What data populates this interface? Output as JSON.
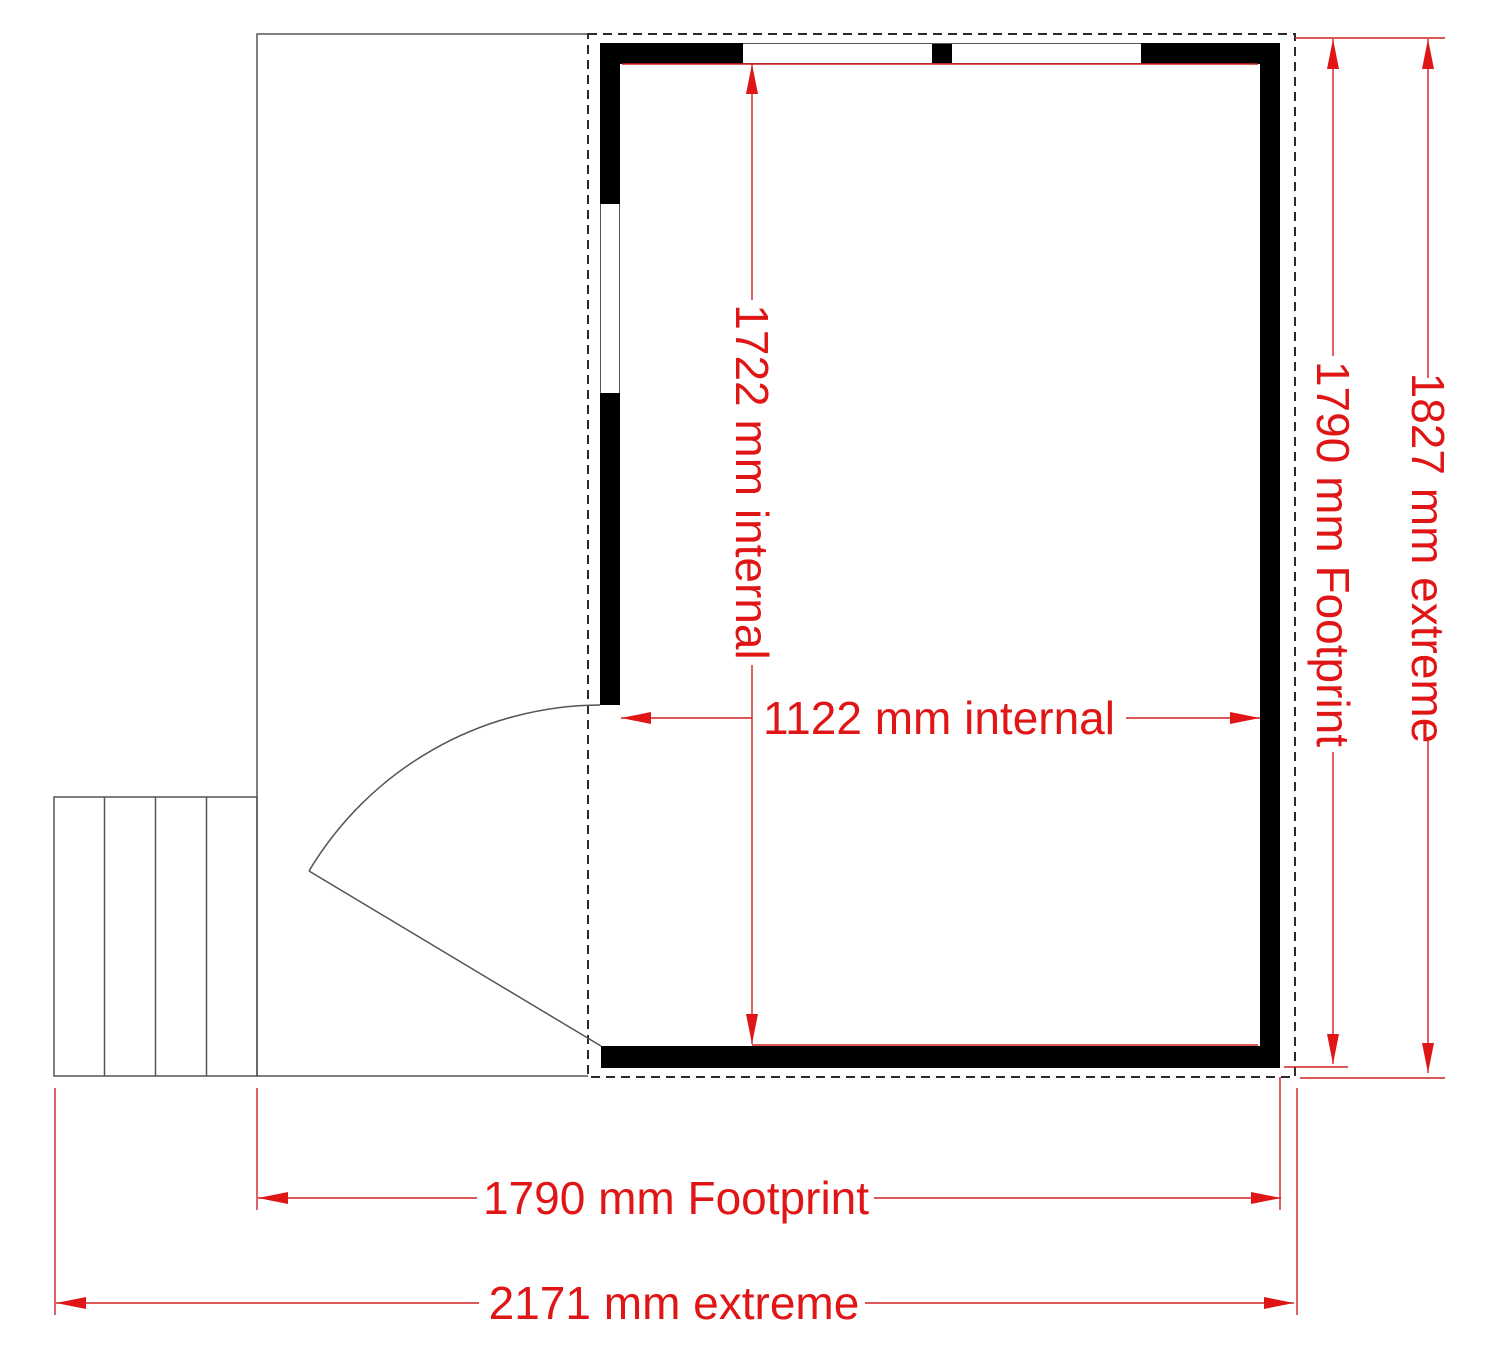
{
  "drawing": {
    "kind": "floor-plan",
    "background": "#ffffff"
  },
  "dimensions": {
    "internal_height": {
      "label": "1722 mm internal",
      "value": 1722,
      "unit": "mm",
      "orientation": "vertical"
    },
    "internal_width": {
      "label": "1122 mm internal",
      "value": 1122,
      "unit": "mm",
      "orientation": "horizontal"
    },
    "footprint_height": {
      "label": "1790 mm Footprint",
      "value": 1790,
      "unit": "mm",
      "orientation": "vertical"
    },
    "extreme_height": {
      "label": "1827 mm extreme",
      "value": 1827,
      "unit": "mm",
      "orientation": "vertical"
    },
    "footprint_width": {
      "label": "1790 mm Footprint",
      "value": 1790,
      "unit": "mm",
      "orientation": "horizontal"
    },
    "extreme_width": {
      "label": "2171 mm extreme",
      "value": 2171,
      "unit": "mm",
      "orientation": "horizontal"
    }
  },
  "features": {
    "step_treads": 4,
    "windows": 3,
    "doors": 1
  },
  "colors": {
    "dimension_red": "#e01616",
    "wall_black": "#000000",
    "outline_gray": "#555555",
    "dashed_outline": "#2b2b2b"
  }
}
